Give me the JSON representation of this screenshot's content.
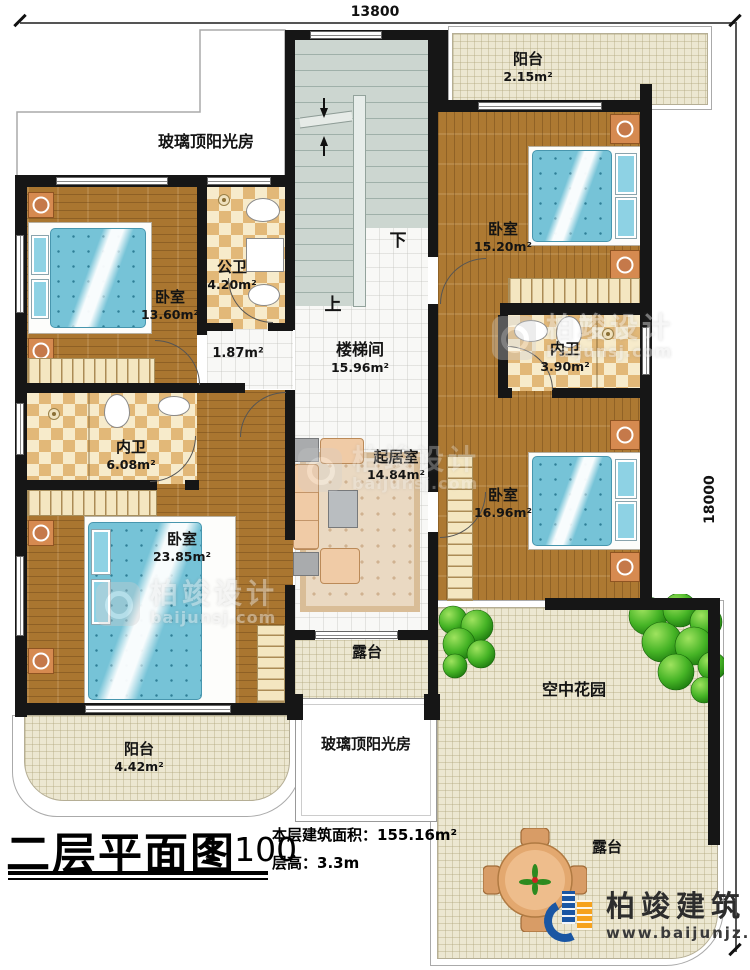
{
  "plan": {
    "dim_width": "13800",
    "dim_height": "18000",
    "title": "二层平面图",
    "scale": "1:100",
    "floor_area_label": "本层建筑面积：",
    "floor_area_value": "155.16m²",
    "floor_height_label": "层高：",
    "floor_height_value": "3.3m"
  },
  "rooms": {
    "sunroom_top": {
      "name": "玻璃顶阳光房"
    },
    "sunroom_bottom": {
      "name": "玻璃顶阳光房"
    },
    "balcony_top": {
      "name": "阳台",
      "area": "2.15m²"
    },
    "balcony_bottom": {
      "name": "阳台",
      "area": "4.42m²"
    },
    "bedroom_top_right": {
      "name": "卧室",
      "area": "15.20m²"
    },
    "bedroom_top_left": {
      "name": "卧室",
      "area": "13.60m²"
    },
    "bedroom_left": {
      "name": "卧室",
      "area": "23.85m²"
    },
    "bedroom_right": {
      "name": "卧室",
      "area": "16.96m²"
    },
    "bath_public": {
      "name": "公卫",
      "area": "4.20m²"
    },
    "bath_ensuite_left": {
      "name": "内卫",
      "area": "6.08m²"
    },
    "bath_ensuite_right": {
      "name": "内卫",
      "area": "3.90m²"
    },
    "hallway": {
      "area": "1.87m²"
    },
    "stairwell": {
      "name": "楼梯间",
      "area": "15.96m²"
    },
    "living": {
      "name": "起居室",
      "area": "14.84m²"
    },
    "terrace_mid": {
      "name": "露台"
    },
    "terrace_garden": {
      "name": "露台"
    },
    "sky_garden": {
      "name": "空中花园"
    },
    "stairs_down": "下",
    "stairs_up": "上"
  },
  "watermark": {
    "cn": "柏竣设计",
    "site": "baijunsj.com"
  },
  "logo": {
    "cn": "柏竣建筑",
    "site": "www.baijunjz.com"
  },
  "colors": {
    "wall": "#161616",
    "wood": "#aa7630",
    "bed_blue": "#76c3d7",
    "bath_tile": "#e2b878",
    "outdoor_cream": "#ece7d1",
    "stair_gray": "#ccd6d0",
    "tree_green": "#3ba81e",
    "logo_blue": "#1a56a3",
    "logo_orange": "#f6a21c"
  }
}
